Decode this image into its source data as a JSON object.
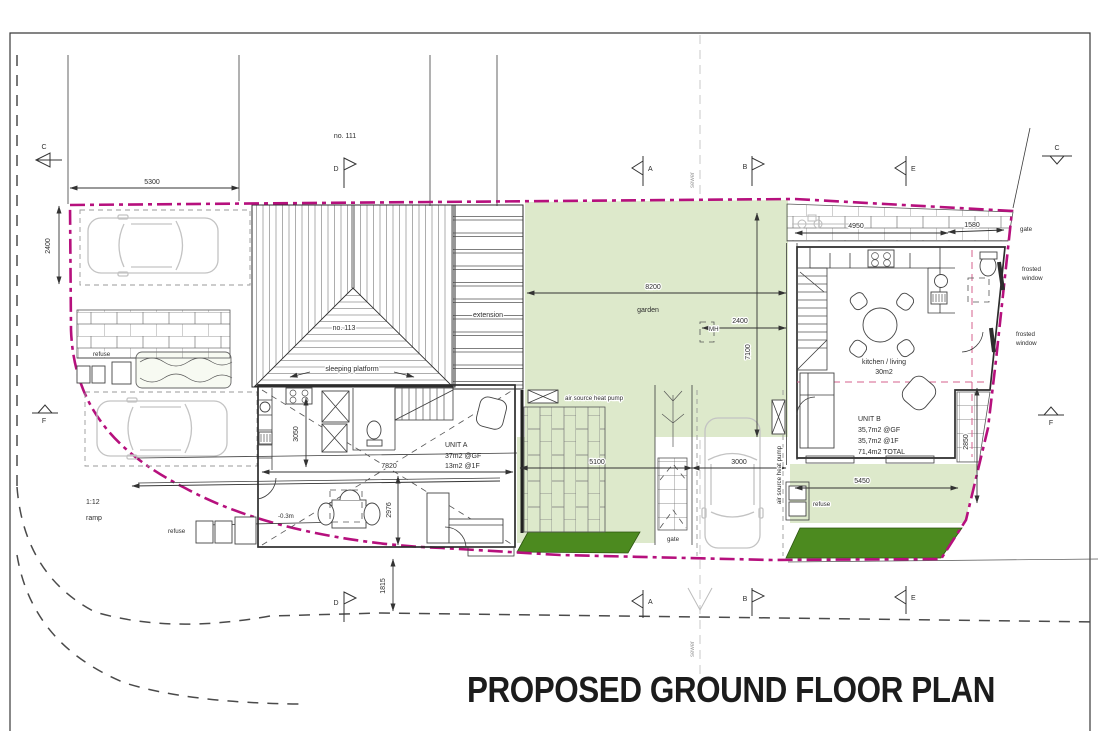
{
  "title": "PROPOSED GROUND FLOOR PLAN",
  "labels": {
    "no_111": "no. 111",
    "no_113": "no. 113",
    "sleeping_platform": "sleeping platform",
    "extension": "extension",
    "garden": "garden",
    "manhole": "MH",
    "sewer": "sewer",
    "gate": "gate",
    "frosted_line1": "frosted",
    "frosted_line2": "window",
    "air_source_heat_pump": "air source heat pump",
    "refuse": "refuse",
    "ramp_gradient": "1:12",
    "ramp": "ramp",
    "floor_level": "-0.3m",
    "kitchen_living": "kitchen / living",
    "kitchen_living_area": "30m2"
  },
  "unit_a": {
    "name": "UNIT A",
    "area_gf": "37m2 @GF",
    "area_1f": "13m2 @1F"
  },
  "unit_b": {
    "name": "UNIT B",
    "area_gf": "35,7m2 @GF",
    "area_1f": "35,7m2 @1F",
    "area_total": "71,4m2 TOTAL"
  },
  "dimensions": {
    "parking_width": "5300",
    "parking_depth": "2400",
    "garden_width": "8200",
    "garden_mh_offset": "2400",
    "garden_depth": "7100",
    "rear_lane_a": "4950",
    "rear_lane_b": "1580",
    "unit_a_width": "7820",
    "unit_a_living_depth": "2976",
    "unit_a_kitchen_depth": "3050",
    "patio_width": "5100",
    "parking_bay_width": "3000",
    "unit_b_garden_width": "5450",
    "unit_b_depth": "2850",
    "frontage_depth": "1815"
  },
  "section_markers": {
    "a": "A",
    "b": "B",
    "c": "C",
    "d": "D",
    "e": "E",
    "f": "F"
  },
  "colors": {
    "boundary": "#b6107d",
    "garden_fill": "#dde9cb",
    "hedge_fill": "#4c8a1f",
    "drawing_line": "#3c3c3c",
    "faded": "#c3c3c3"
  }
}
